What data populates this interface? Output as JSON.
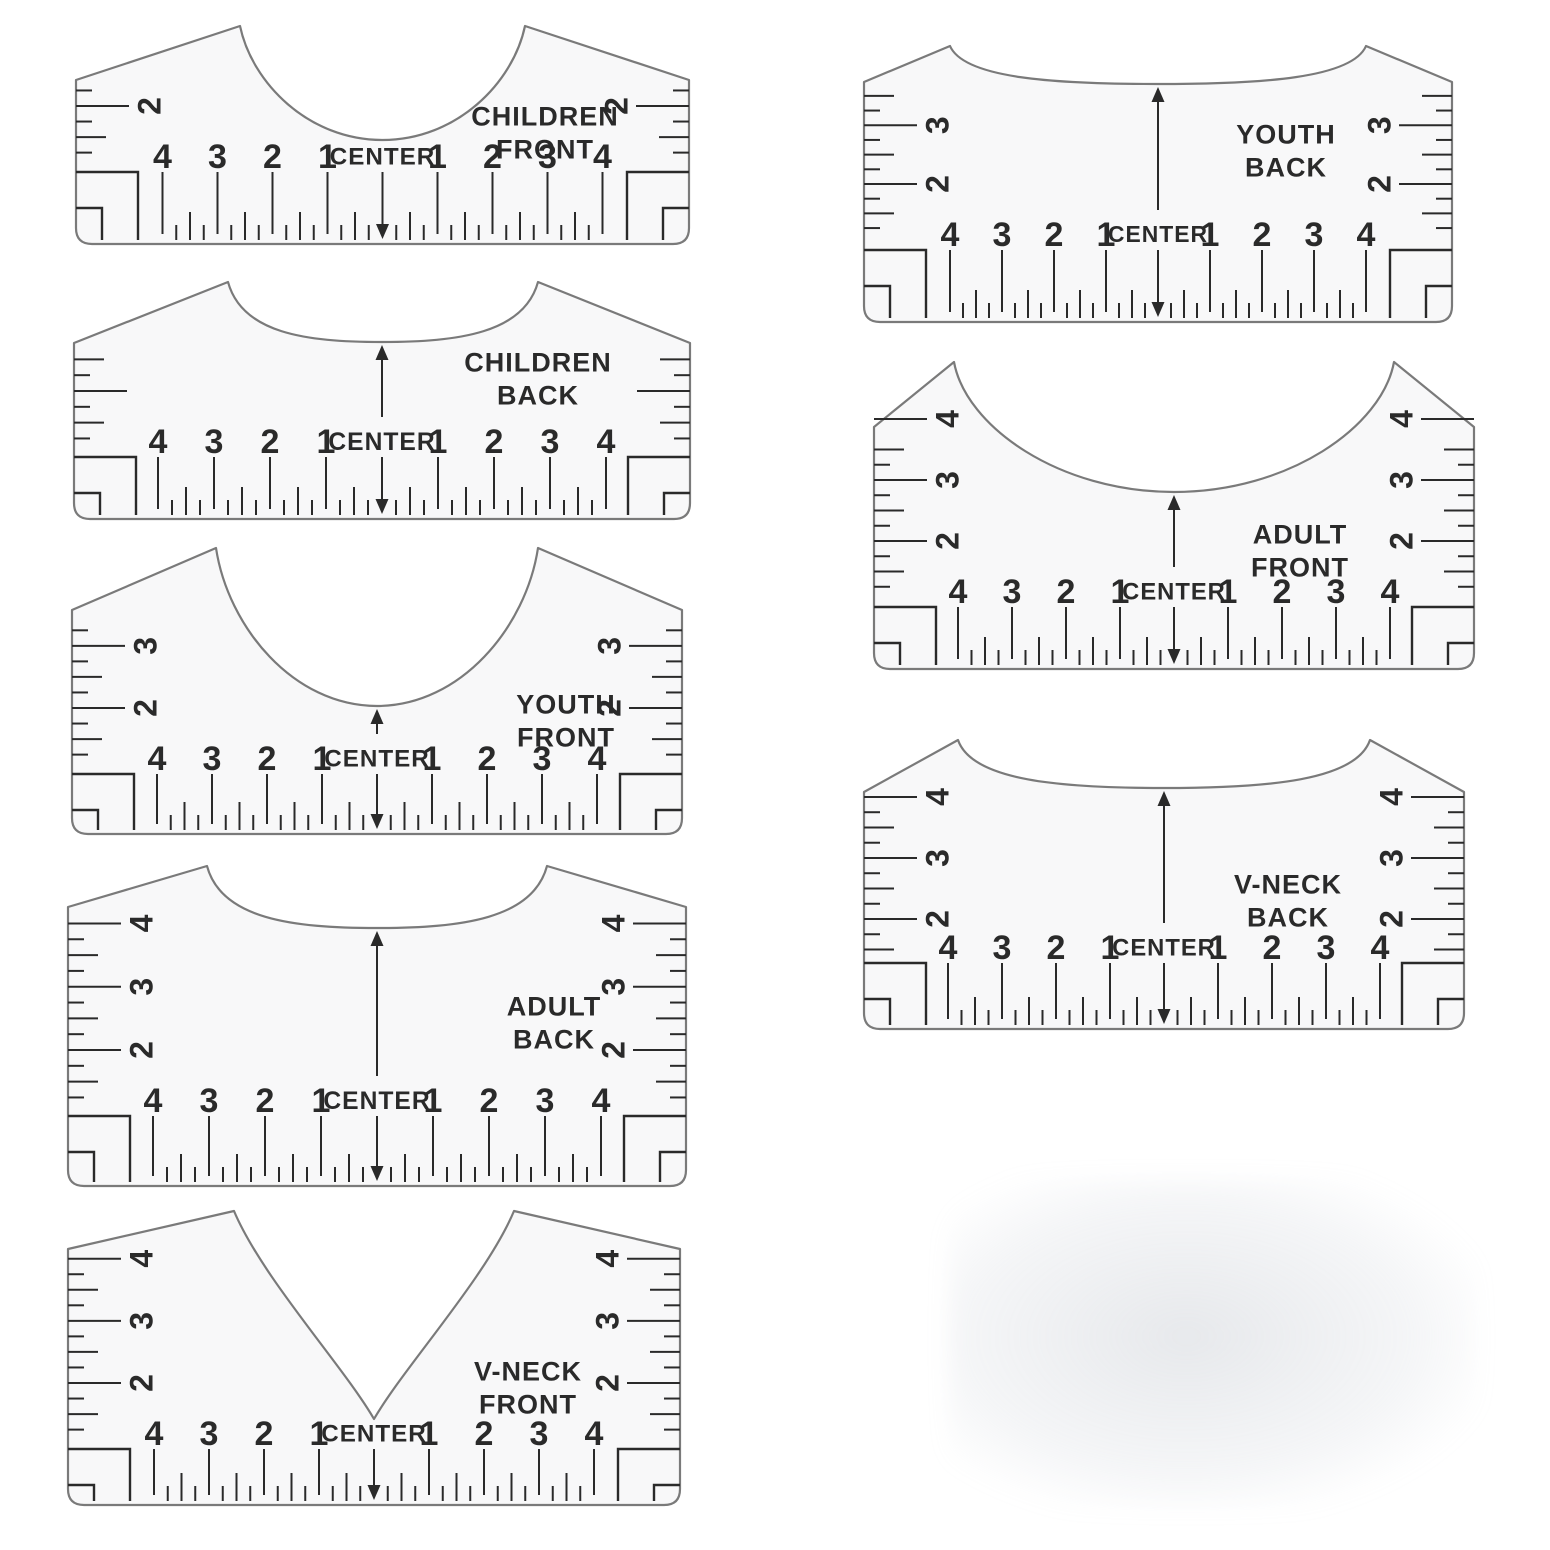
{
  "title": "T-Shirt Alignment Ruler Set",
  "shared": {
    "center_label": "CENTER",
    "scale_numbers": [
      "4",
      "3",
      "2",
      "1",
      "CENTER",
      "1",
      "2",
      "3",
      "4"
    ],
    "ink_color": "#2a2a2a",
    "outline_color": "#7a7a7a",
    "body_fill": "#f8f8f9",
    "background": "#ffffff",
    "shadow_color": "#c9ced6"
  },
  "rulers": [
    {
      "id": "children-front",
      "label_line1": "CHILDREN",
      "label_line2": "FRONT",
      "neck": "scoop",
      "side_numbers": [
        "2"
      ],
      "up_arrow": false,
      "down_arrow": true,
      "geom": {
        "x": 70,
        "y": 18,
        "w": 625,
        "h": 234,
        "s": 55,
        "row_off": 96,
        "peaks": [
          170,
          455
        ],
        "peak_y": 8,
        "neck_y": 122,
        "slant_y": 62,
        "side_max": 2,
        "side_off": 50,
        "label_x": 475,
        "label_y": 98
      }
    },
    {
      "id": "children-back",
      "label_line1": "CHILDREN",
      "label_line2": "BACK",
      "neck": "back",
      "side_numbers": [],
      "up_arrow": true,
      "down_arrow": true,
      "geom": {
        "x": 68,
        "y": 272,
        "w": 628,
        "h": 255,
        "s": 56,
        "row_off": 86,
        "peaks": [
          160,
          470
        ],
        "peak_y": 10,
        "neck_y": 70,
        "slant_y": 71,
        "side_max": 3,
        "side_off": 50,
        "label_x": 470,
        "label_y": 90
      }
    },
    {
      "id": "youth-front",
      "label_line1": "YOUTH",
      "label_line2": "FRONT",
      "neck": "scoop",
      "side_numbers": [
        "3",
        "2"
      ],
      "up_arrow": true,
      "down_arrow": true,
      "geom": {
        "x": 66,
        "y": 540,
        "w": 622,
        "h": 302,
        "s": 55,
        "row_off": 84,
        "peaks": [
          150,
          472
        ],
        "peak_y": 8,
        "neck_y": 166,
        "slant_y": 70,
        "side_max": 3,
        "side_off": 50,
        "label_x": 500,
        "label_y": 164
      }
    },
    {
      "id": "adult-back",
      "label_line1": "ADULT",
      "label_line2": "BACK",
      "neck": "back",
      "side_numbers": [
        "4",
        "3",
        "2"
      ],
      "up_arrow": true,
      "down_arrow": true,
      "geom": {
        "x": 62,
        "y": 858,
        "w": 630,
        "h": 336,
        "s": 56,
        "row_off": 94,
        "peaks": [
          145,
          485
        ],
        "peak_y": 8,
        "neck_y": 70,
        "slant_y": 49,
        "side_max": 4,
        "side_off": 50,
        "label_x": 492,
        "label_y": 148
      }
    },
    {
      "id": "v-neck-front",
      "label_line1": "V-NECK",
      "label_line2": "FRONT",
      "neck": "vneck",
      "side_numbers": [
        "4",
        "3",
        "2"
      ],
      "up_arrow": false,
      "down_arrow": true,
      "geom": {
        "x": 62,
        "y": 1203,
        "w": 624,
        "h": 310,
        "s": 55,
        "row_off": 80,
        "peaks": [
          172,
          452
        ],
        "peak_y": 8,
        "neck_y": 216,
        "slant_y": 46,
        "side_max": 4,
        "side_off": 50,
        "label_x": 466,
        "label_y": 168
      }
    },
    {
      "id": "youth-back",
      "label_line1": "YOUTH",
      "label_line2": "BACK",
      "neck": "back",
      "side_numbers": [
        "3",
        "2"
      ],
      "up_arrow": true,
      "down_arrow": true,
      "geom": {
        "x": 858,
        "y": 38,
        "w": 600,
        "h": 292,
        "s": 52,
        "row_off": 96,
        "peaks": [
          92,
          508
        ],
        "peak_y": 8,
        "neck_y": 46,
        "slant_y": 44,
        "side_max": 3,
        "side_off": 50,
        "label_x": 428,
        "label_y": 96
      }
    },
    {
      "id": "adult-front",
      "label_line1": "ADULT",
      "label_line2": "FRONT",
      "neck": "scoop",
      "side_numbers": [
        "4",
        "3",
        "2"
      ],
      "up_arrow": true,
      "down_arrow": true,
      "geom": {
        "x": 868,
        "y": 352,
        "w": 612,
        "h": 325,
        "s": 54,
        "row_off": 86,
        "peaks": [
          86,
          526
        ],
        "peak_y": 10,
        "neck_y": 140,
        "slant_y": 75,
        "side_max": 4,
        "side_off": 50,
        "label_x": 432,
        "label_y": 182
      }
    },
    {
      "id": "v-neck-back",
      "label_line1": "V-NECK",
      "label_line2": "BACK",
      "neck": "back",
      "side_numbers": [
        "4",
        "3",
        "2"
      ],
      "up_arrow": true,
      "down_arrow": true,
      "geom": {
        "x": 858,
        "y": 732,
        "w": 612,
        "h": 305,
        "s": 54,
        "row_off": 90,
        "peaks": [
          100,
          512
        ],
        "peak_y": 8,
        "neck_y": 56,
        "slant_y": 60,
        "side_max": 4,
        "side_off": 28,
        "label_x": 430,
        "label_y": 152
      }
    }
  ]
}
